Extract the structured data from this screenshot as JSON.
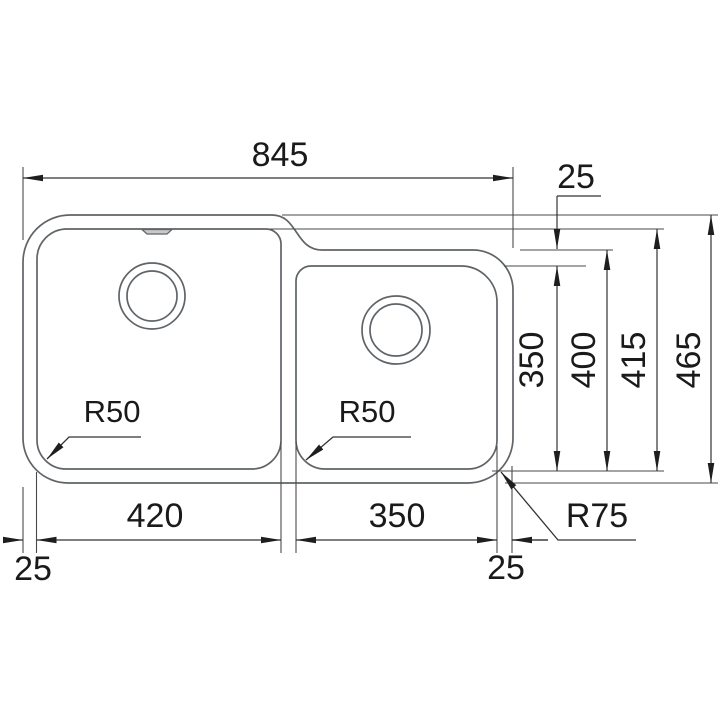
{
  "drawing": {
    "type": "technical-dimension-drawing",
    "subject": "double-bowl undermount kitchen sink, plan view",
    "overall_width": "845",
    "overall_depth": "465",
    "left_bowl_width": "420",
    "left_bowl_depth": "415",
    "right_bowl_width": "350",
    "right_bowl_depth": "350",
    "right_outer_depth": "400",
    "rim_top_right": "25",
    "rim_bottom_left": "25",
    "rim_bottom_right": "25",
    "left_bowl_corner_radius": "R50",
    "right_bowl_corner_radius": "R50",
    "outer_corner_radius": "R75",
    "colors": {
      "background": "#ffffff",
      "outline": "#5f6468",
      "dimension_lines": "#333333",
      "text": "#1a1a1a"
    }
  }
}
